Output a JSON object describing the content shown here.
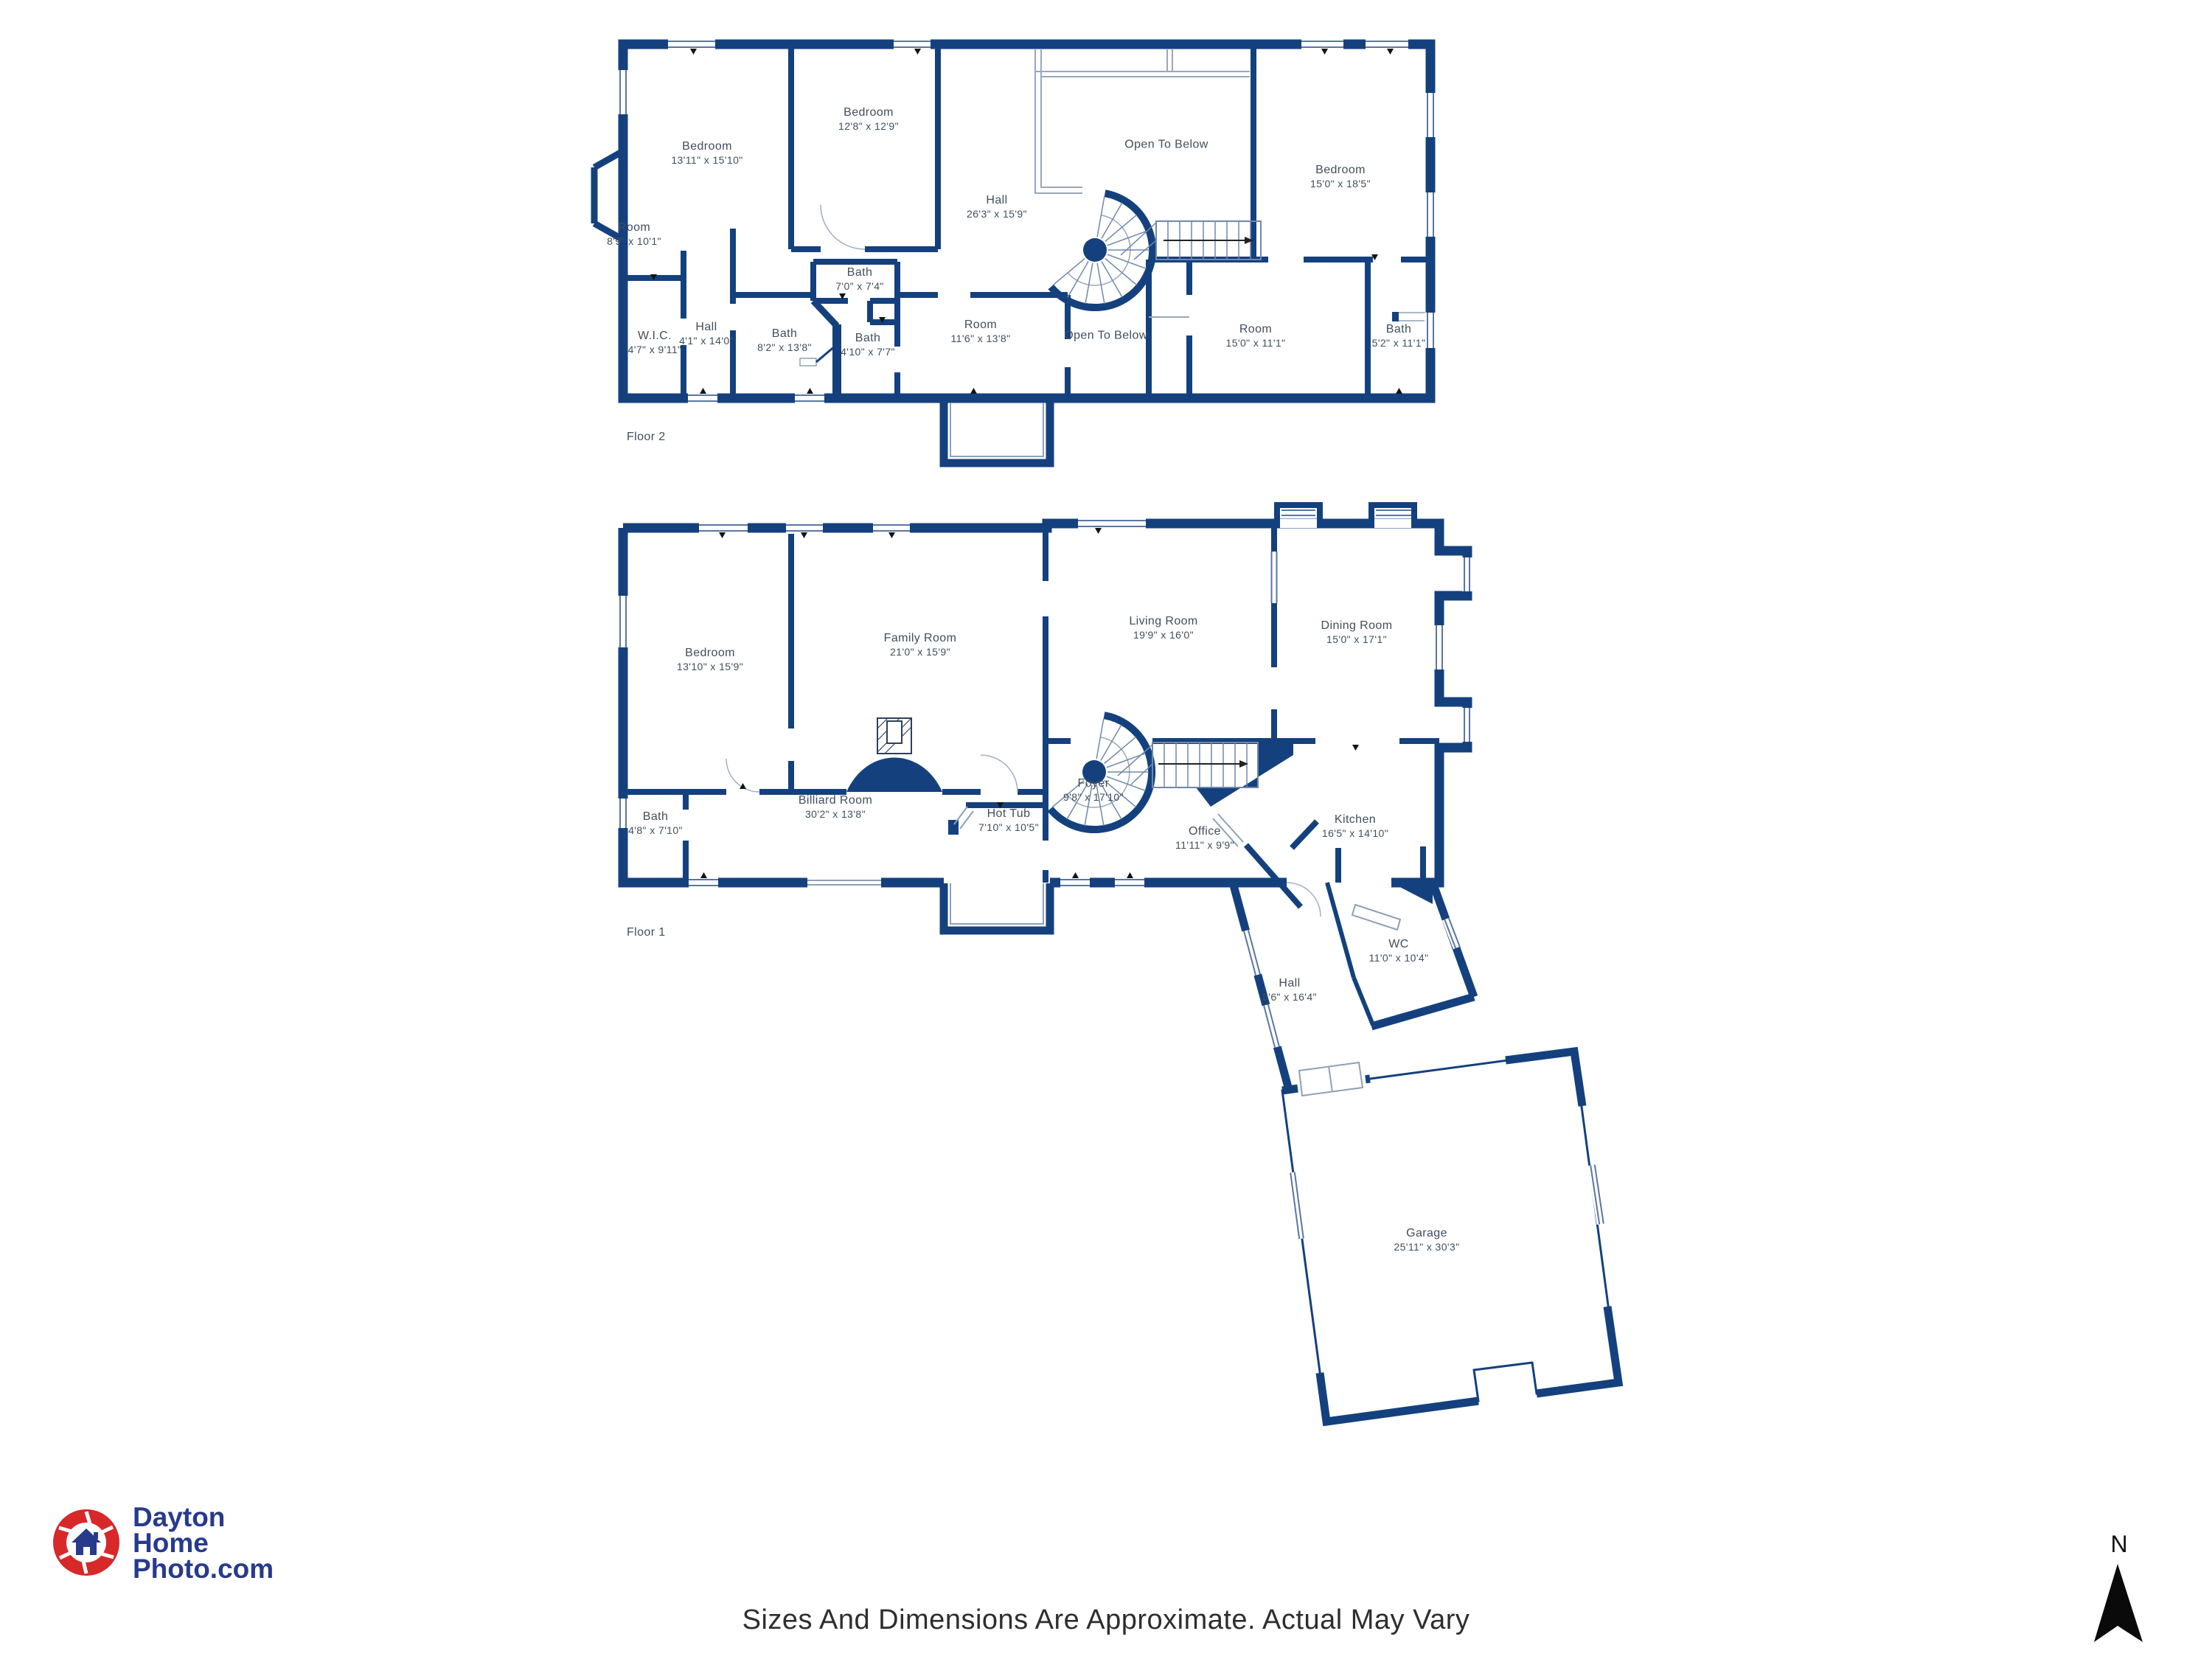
{
  "floor2": {
    "caption": "Floor 2",
    "rooms": [
      {
        "name": "Bedroom",
        "dims": "13'11\" x 15'10\""
      },
      {
        "name": "Bedroom",
        "dims": "12'8\" x 12'9\""
      },
      {
        "name": "Hall",
        "dims": "26'3\" x 15'9\""
      },
      {
        "name": "Open To Below",
        "dims": ""
      },
      {
        "name": "Bedroom",
        "dims": "15'0\" x 18'5\""
      },
      {
        "name": "Room",
        "dims": "8'9\" x 10'1\""
      },
      {
        "name": "W.I.C.",
        "dims": "4'7\" x 9'11\""
      },
      {
        "name": "Hall",
        "dims": "4'1\" x 14'0\""
      },
      {
        "name": "Bath",
        "dims": "8'2\" x 13'8\""
      },
      {
        "name": "Bath",
        "dims": "7'0\" x 7'4\""
      },
      {
        "name": "Bath",
        "dims": "4'10\" x 7'7\""
      },
      {
        "name": "Room",
        "dims": "11'6\" x 13'8\""
      },
      {
        "name": "Open To Below",
        "dims": ""
      },
      {
        "name": "Room",
        "dims": "15'0\" x 11'1\""
      },
      {
        "name": "Bath",
        "dims": "5'2\" x 11'1\""
      }
    ]
  },
  "floor1": {
    "caption": "Floor 1",
    "rooms": [
      {
        "name": "Bedroom",
        "dims": "13'10\" x 15'9\""
      },
      {
        "name": "Family Room",
        "dims": "21'0\" x 15'9\""
      },
      {
        "name": "Living Room",
        "dims": "19'9\" x 16'0\""
      },
      {
        "name": "Dining Room",
        "dims": "15'0\" x 17'1\""
      },
      {
        "name": "Bath",
        "dims": "4'8\" x 7'10\""
      },
      {
        "name": "Billiard Room",
        "dims": "30'2\" x 13'8\""
      },
      {
        "name": "Hot Tub",
        "dims": "7'10\" x 10'5\""
      },
      {
        "name": "Foyer",
        "dims": "9'8\" x 17'10\""
      },
      {
        "name": "Office",
        "dims": "11'11\" x 9'9\""
      },
      {
        "name": "Kitchen",
        "dims": "16'5\" x 14'10\""
      },
      {
        "name": "WC",
        "dims": "11'0\" x 10'4\""
      },
      {
        "name": "Hall",
        "dims": "5'6\" x 16'4\""
      },
      {
        "name": "Garage",
        "dims": "25'11\" x 30'3\""
      }
    ]
  },
  "footer": {
    "disclaimer": "Sizes And Dimensions Are Approximate. Actual May Vary"
  },
  "logo": {
    "line1": "Dayton",
    "line2": "Home",
    "line3": "Photo.com"
  },
  "compass": {
    "label": "N"
  },
  "colors": {
    "wall": "#14417e",
    "thin_line": "#8da0b6",
    "tread": "#7088a8",
    "label_text": "#414e5c",
    "logo_navy": "#283a8c",
    "logo_red": "#d7282a"
  }
}
